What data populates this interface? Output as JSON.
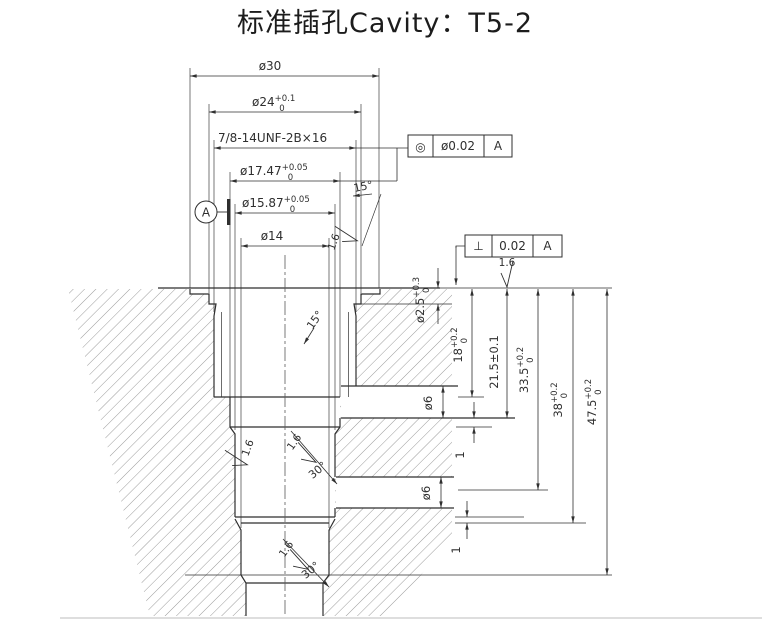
{
  "title": "标准插孔Cavity：T5-2",
  "dims": {
    "d30": {
      "text": "ø30"
    },
    "d24": {
      "text": "ø24",
      "sup": "+0.1",
      "sub": "0"
    },
    "thread": {
      "text": "7/8-14UNF-2B×16"
    },
    "d1747": {
      "text": "ø17.47",
      "sup": "+0.05",
      "sub": "0"
    },
    "d1587": {
      "text": "ø15.87",
      "sup": "+0.05",
      "sub": "0"
    },
    "d14": {
      "text": "ø14"
    },
    "d25": {
      "text": "ø2.5",
      "sup": "+0.3",
      "sub": "0"
    },
    "d18": {
      "text": "18",
      "sup": "+0.2",
      "sub": "0"
    },
    "d215": {
      "text": "21.5±0.1"
    },
    "d335": {
      "text": "33.5",
      "sup": "+0.2",
      "sub": "0"
    },
    "d38": {
      "text": "38",
      "sup": "+0.2",
      "sub": "0"
    },
    "d475": {
      "text": "47.5",
      "sup": "+0.2",
      "sub": "0"
    },
    "d6_upper": {
      "text": "ø6"
    },
    "d6_lower": {
      "text": "ø6"
    },
    "step1": {
      "text": "1"
    },
    "step2": {
      "text": "1"
    }
  },
  "angles": {
    "taper": "15°",
    "inner": "15°",
    "chamfer_upper": "30°",
    "chamfer_lower": "30°"
  },
  "roughness": {
    "value": "1.6"
  },
  "fcf_concentricity": {
    "symbol": "◎",
    "tolerance": "ø0.02",
    "datum": "A"
  },
  "fcf_perpendicularity": {
    "symbol": "⊥",
    "tolerance": "0.02",
    "datum": "A"
  },
  "datum": {
    "label": "A"
  },
  "colors": {
    "line": "#2f2f2f",
    "hatch": "#6f6f6f",
    "faint": "#c9c9c9"
  }
}
